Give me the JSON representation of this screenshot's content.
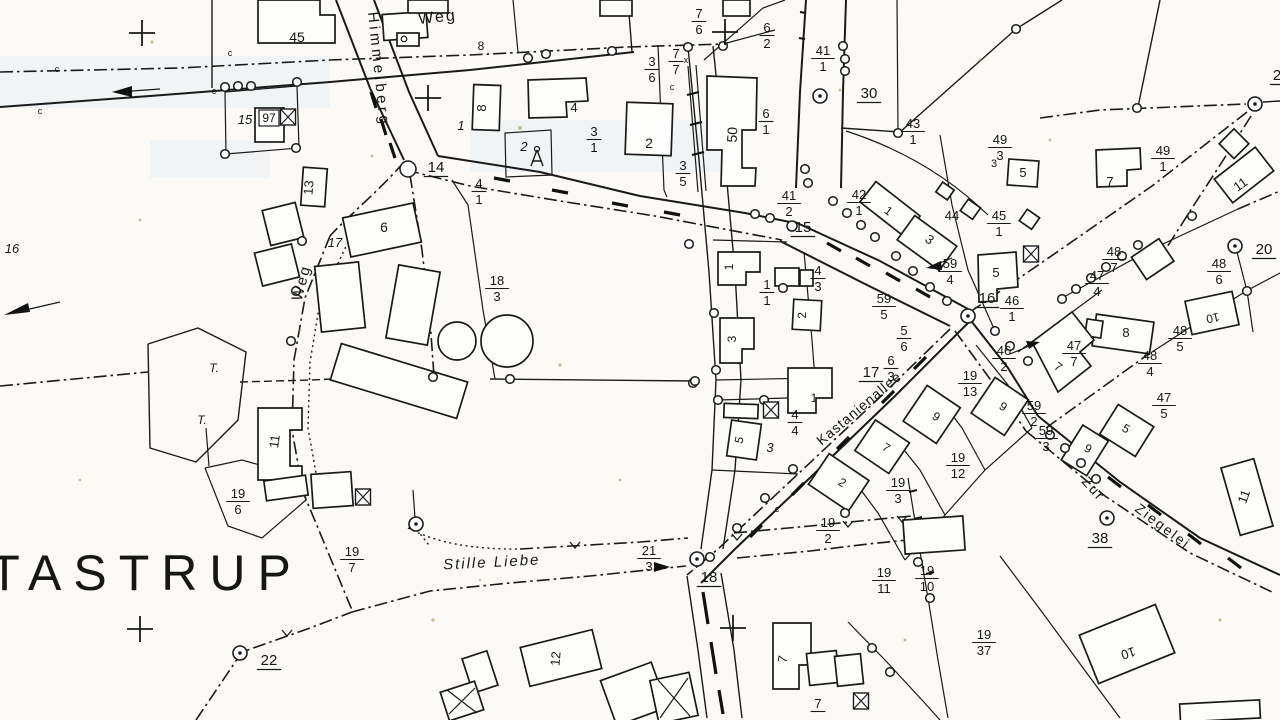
{
  "scan": {
    "background": "#fbfaf7",
    "ink": "#1a1a1a",
    "tint": "#d9e6ec",
    "speck": "#a8885a"
  },
  "map": {
    "place": "TASTRUP",
    "streets": [
      "Himmelberg",
      "Weg",
      "Weg",
      "Stille Liebe",
      "Kastanienallee",
      "Zur Ziegelei"
    ],
    "block_numbers": [
      "14",
      "15",
      "16",
      "17",
      "18",
      "20",
      "22",
      "30",
      "38",
      "2"
    ]
  },
  "labels": [
    {
      "type": "place",
      "text": "TASTRUP",
      "x": 146,
      "y": 590,
      "size": 50,
      "spacing": 12
    },
    {
      "type": "street",
      "text": "Weg",
      "x": 438,
      "y": 22,
      "rot": -6,
      "size": 16,
      "spacing": 2
    },
    {
      "type": "street",
      "text": "Himmelberg",
      "x": 374,
      "y": 70,
      "rot": 84,
      "size": 15,
      "spacing": 3.5
    },
    {
      "type": "street",
      "text": "Weg",
      "x": 306,
      "y": 284,
      "rot": -75,
      "size": 15,
      "spacing": 2
    },
    {
      "type": "street",
      "text": "Stille Liebe",
      "x": 492,
      "y": 567,
      "rot": -3,
      "size": 15,
      "spacing": 2,
      "style": "italic"
    },
    {
      "type": "street",
      "text": "Kastanienallee",
      "x": 862,
      "y": 412,
      "rot": -40,
      "size": 14,
      "spacing": 1
    },
    {
      "type": "street",
      "text": "Zur",
      "x": 1090,
      "y": 492,
      "rot": 48,
      "size": 14,
      "spacing": 2
    },
    {
      "type": "street",
      "text": "Ziegelei",
      "x": 1160,
      "y": 530,
      "rot": 37,
      "size": 14,
      "spacing": 2
    },
    {
      "type": "block",
      "text": "14",
      "x": 436,
      "y": 172
    },
    {
      "type": "block",
      "text": "15",
      "x": 803,
      "y": 232
    },
    {
      "type": "block",
      "text": "16",
      "x": 987,
      "y": 303
    },
    {
      "type": "block",
      "text": "17",
      "x": 871,
      "y": 377
    },
    {
      "type": "block",
      "text": "18",
      "x": 709,
      "y": 582
    },
    {
      "type": "block",
      "text": "20",
      "x": 1264,
      "y": 254
    },
    {
      "type": "block",
      "text": "22",
      "x": 269,
      "y": 665
    },
    {
      "type": "block",
      "text": "30",
      "x": 869,
      "y": 98
    },
    {
      "type": "block",
      "text": "38",
      "x": 1100,
      "y": 543
    },
    {
      "type": "block",
      "text": "2",
      "x": 1277,
      "y": 80
    },
    {
      "type": "parcel",
      "num": "7",
      "den": "6",
      "x": 699,
      "y": 20
    },
    {
      "type": "parcel",
      "num": "6",
      "den": "2",
      "x": 767,
      "y": 34
    },
    {
      "type": "parcel",
      "num": "3",
      "den": "6",
      "x": 652,
      "y": 68
    },
    {
      "type": "parcel",
      "num": "7",
      "den": "7",
      "x": 676,
      "y": 60
    },
    {
      "type": "parcel",
      "num": "41",
      "den": "1",
      "x": 823,
      "y": 57
    },
    {
      "type": "parcel",
      "num": "43",
      "den": "1",
      "x": 913,
      "y": 130
    },
    {
      "type": "parcel",
      "num": "49",
      "den": "3",
      "x": 1000,
      "y": 146
    },
    {
      "type": "parcel",
      "num": "49",
      "den": "1",
      "x": 1163,
      "y": 157
    },
    {
      "type": "parcel",
      "num": "6",
      "den": "1",
      "x": 766,
      "y": 120
    },
    {
      "type": "parcel",
      "num": "3",
      "den": "1",
      "x": 594,
      "y": 138
    },
    {
      "type": "parcel",
      "num": "3",
      "den": "5",
      "x": 683,
      "y": 172
    },
    {
      "type": "parcel",
      "num": "4",
      "den": "1",
      "x": 479,
      "y": 190
    },
    {
      "type": "parcel",
      "num": "42",
      "den": "1",
      "x": 859,
      "y": 201
    },
    {
      "type": "parcel",
      "num": "41",
      "den": "2",
      "x": 789,
      "y": 202
    },
    {
      "type": "parcel",
      "num": "45",
      "den": "1",
      "x": 999,
      "y": 222
    },
    {
      "type": "parcel",
      "num": "59",
      "den": "4",
      "x": 950,
      "y": 270
    },
    {
      "type": "parcel",
      "num": "4",
      "den": "3",
      "x": 818,
      "y": 277
    },
    {
      "type": "parcel",
      "num": "1",
      "den": "1",
      "x": 767,
      "y": 291
    },
    {
      "type": "parcel",
      "num": "5",
      "den": "6",
      "x": 904,
      "y": 337
    },
    {
      "type": "parcel",
      "num": "59",
      "den": "5",
      "x": 884,
      "y": 305
    },
    {
      "type": "parcel",
      "num": "46",
      "den": "1",
      "x": 1012,
      "y": 307
    },
    {
      "type": "parcel",
      "num": "48",
      "den": "7",
      "x": 1114,
      "y": 258
    },
    {
      "type": "parcel",
      "num": "47",
      "den": "4",
      "x": 1097,
      "y": 282
    },
    {
      "type": "parcel",
      "num": "48",
      "den": "6",
      "x": 1219,
      "y": 270
    },
    {
      "type": "parcel",
      "num": "46",
      "den": "2",
      "x": 1004,
      "y": 357
    },
    {
      "type": "parcel",
      "num": "19",
      "den": "13",
      "x": 970,
      "y": 382
    },
    {
      "type": "parcel",
      "num": "6",
      "den": "3",
      "x": 891,
      "y": 367
    },
    {
      "type": "parcel",
      "num": "48",
      "den": "5",
      "x": 1180,
      "y": 337
    },
    {
      "type": "parcel",
      "num": "48",
      "den": "4",
      "x": 1150,
      "y": 362
    },
    {
      "type": "parcel",
      "num": "47",
      "den": "7",
      "x": 1074,
      "y": 352
    },
    {
      "type": "parcel",
      "num": "47",
      "den": "5",
      "x": 1164,
      "y": 404
    },
    {
      "type": "parcel",
      "num": "59",
      "den": "2",
      "x": 1034,
      "y": 412
    },
    {
      "type": "parcel",
      "num": "59",
      "den": "3",
      "x": 1046,
      "y": 437
    },
    {
      "type": "parcel",
      "num": "4",
      "den": "4",
      "x": 795,
      "y": 421
    },
    {
      "type": "parcel",
      "num": "19",
      "den": "3",
      "x": 898,
      "y": 489
    },
    {
      "type": "parcel",
      "num": "19",
      "den": "12",
      "x": 958,
      "y": 464
    },
    {
      "type": "parcel",
      "num": "19",
      "den": "2",
      "x": 828,
      "y": 529
    },
    {
      "type": "parcel",
      "num": "19",
      "den": "11",
      "x": 884,
      "y": 579
    },
    {
      "type": "parcel",
      "num": "19",
      "den": "10",
      "x": 927,
      "y": 577
    },
    {
      "type": "parcel",
      "num": "21",
      "den": "3",
      "x": 649,
      "y": 557
    },
    {
      "type": "parcel",
      "num": "19",
      "den": "6",
      "x": 238,
      "y": 500
    },
    {
      "type": "parcel",
      "num": "19",
      "den": "7",
      "x": 352,
      "y": 558
    },
    {
      "type": "parcel",
      "num": "19",
      "den": "37",
      "x": 984,
      "y": 641
    },
    {
      "type": "parcel",
      "num": "18",
      "den": "3",
      "x": 497,
      "y": 287
    },
    {
      "type": "parcel",
      "num": "7",
      "den": "",
      "x": 818,
      "y": 710
    },
    {
      "type": "house",
      "text": "45",
      "x": 297,
      "y": 42,
      "size": 14
    },
    {
      "type": "house",
      "text": "8",
      "x": 481,
      "y": 50,
      "size": 12
    },
    {
      "type": "house",
      "text": "8",
      "x": 486,
      "y": 108,
      "rot": -90,
      "size": 13
    },
    {
      "type": "house",
      "text": "1",
      "x": 461,
      "y": 130,
      "style": "italic"
    },
    {
      "type": "house",
      "text": "4",
      "x": 574,
      "y": 112,
      "size": 13
    },
    {
      "type": "house",
      "text": "2",
      "x": 524,
      "y": 151,
      "style": "italic"
    },
    {
      "type": "house",
      "text": "2",
      "x": 649,
      "y": 148,
      "size": 14
    },
    {
      "type": "house",
      "text": "50",
      "x": 737,
      "y": 135,
      "rot": -87,
      "size": 14
    },
    {
      "type": "house",
      "text": "13",
      "x": 313,
      "y": 188,
      "rot": -85,
      "size": 13
    },
    {
      "type": "house",
      "text": "6",
      "x": 384,
      "y": 232,
      "size": 14
    },
    {
      "type": "house",
      "text": "17",
      "x": 335,
      "y": 247,
      "style": "italic"
    },
    {
      "type": "house",
      "text": "16",
      "x": 12,
      "y": 253,
      "style": "italic"
    },
    {
      "type": "house",
      "text": "15",
      "x": 245,
      "y": 124,
      "style": "italic"
    },
    {
      "type": "plate",
      "text": "97",
      "x": 269,
      "y": 122,
      "size": 12
    },
    {
      "type": "house",
      "text": "11",
      "x": 279,
      "y": 442,
      "rot": -82,
      "size": 13
    },
    {
      "type": "house",
      "text": "12",
      "x": 560,
      "y": 659,
      "rot": -85,
      "size": 13
    },
    {
      "type": "house",
      "text": "7",
      "x": 787,
      "y": 660,
      "rot": -80,
      "size": 13
    },
    {
      "type": "house",
      "text": "10",
      "x": 1127,
      "y": 649,
      "rot": 163,
      "size": 13
    },
    {
      "type": "house",
      "text": "11",
      "x": 1248,
      "y": 498,
      "rot": -70,
      "size": 13
    },
    {
      "type": "house",
      "text": "5",
      "x": 743,
      "y": 441,
      "rot": -75,
      "size": 12
    },
    {
      "type": "house",
      "text": "3",
      "x": 770,
      "y": 452,
      "style": "italic"
    },
    {
      "type": "house",
      "text": "1",
      "x": 814,
      "y": 402,
      "size": 12
    },
    {
      "type": "house",
      "text": "2",
      "x": 840,
      "y": 486,
      "rot": 33,
      "size": 12
    },
    {
      "type": "house",
      "text": "7",
      "x": 884,
      "y": 451,
      "rot": 33,
      "size": 12
    },
    {
      "type": "house",
      "text": "9",
      "x": 934,
      "y": 420,
      "rot": 33,
      "size": 12
    },
    {
      "type": "house",
      "text": "9",
      "x": 1001,
      "y": 410,
      "rot": 33,
      "size": 12
    },
    {
      "type": "house",
      "text": "9",
      "x": 1086,
      "y": 452,
      "rot": 30,
      "size": 12
    },
    {
      "type": "house",
      "text": "5",
      "x": 1124,
      "y": 432,
      "rot": 30,
      "size": 12
    },
    {
      "type": "house",
      "text": "7",
      "x": 1056,
      "y": 370,
      "rot": 35,
      "size": 12
    },
    {
      "type": "house",
      "text": "8",
      "x": 1126,
      "y": 337,
      "size": 13
    },
    {
      "type": "house",
      "text": "10",
      "x": 1212,
      "y": 314,
      "rot": 168,
      "size": 12
    },
    {
      "type": "house",
      "text": "1",
      "x": 733,
      "y": 267,
      "rot": -90,
      "size": 12
    },
    {
      "type": "house",
      "text": "3",
      "x": 736,
      "y": 339,
      "rot": -90,
      "size": 12
    },
    {
      "type": "house",
      "text": "2",
      "x": 806,
      "y": 315,
      "rot": -93,
      "size": 12
    },
    {
      "type": "house",
      "text": "1",
      "x": 886,
      "y": 214,
      "rot": 38,
      "size": 12
    },
    {
      "type": "house",
      "text": "3",
      "x": 927,
      "y": 243,
      "rot": 36,
      "size": 13
    },
    {
      "type": "house",
      "text": "5",
      "x": 996,
      "y": 277,
      "size": 13
    },
    {
      "type": "house",
      "text": "44",
      "x": 952,
      "y": 220,
      "size": 13
    },
    {
      "type": "house",
      "text": "3",
      "x": 994,
      "y": 167,
      "size": 11
    },
    {
      "type": "house",
      "text": "5",
      "x": 1023,
      "y": 177,
      "size": 13
    },
    {
      "type": "house",
      "text": "7",
      "x": 1110,
      "y": 186,
      "size": 13
    },
    {
      "type": "house",
      "text": "11",
      "x": 1243,
      "y": 188,
      "rot": -36,
      "size": 13
    },
    {
      "type": "note",
      "text": "T.",
      "x": 214,
      "y": 372,
      "size": 12,
      "style": "italic"
    },
    {
      "type": "note",
      "text": "T.",
      "x": 202,
      "y": 424,
      "size": 12,
      "style": "italic"
    },
    {
      "type": "note",
      "text": "c",
      "x": 57,
      "y": 72,
      "size": 9
    },
    {
      "type": "note",
      "text": "c",
      "x": 40,
      "y": 114,
      "size": 9
    },
    {
      "type": "note",
      "text": "c",
      "x": 230,
      "y": 56,
      "size": 9
    },
    {
      "type": "note",
      "text": "c",
      "x": 214,
      "y": 94,
      "size": 9
    },
    {
      "type": "note",
      "text": "c",
      "x": 672,
      "y": 90,
      "size": 9
    },
    {
      "type": "note",
      "text": "c",
      "x": 777,
      "y": 512,
      "size": 9
    },
    {
      "type": "note",
      "text": "x",
      "x": 686,
      "y": 63,
      "size": 9
    }
  ],
  "markers": {
    "survey_points": [
      [
        820,
        96
      ],
      [
        1255,
        104
      ],
      [
        968,
        316
      ],
      [
        1107,
        518
      ],
      [
        697,
        559
      ],
      [
        240,
        653
      ],
      [
        416,
        524
      ],
      [
        1235,
        246
      ]
    ],
    "grid_crosses": [
      [
        142,
        33
      ],
      [
        428,
        98
      ],
      [
        140,
        629
      ],
      [
        733,
        628
      ],
      [
        725,
        32
      ]
    ],
    "crossed_squares": [
      [
        288,
        117
      ],
      [
        771,
        410
      ],
      [
        861,
        701
      ],
      [
        363,
        497
      ],
      [
        1031,
        254
      ]
    ],
    "tower_symbols": [
      [
        537,
        158
      ]
    ],
    "boundary_points": [
      [
        225,
        87
      ],
      [
        238,
        86
      ],
      [
        251,
        86
      ],
      [
        297,
        82
      ],
      [
        225,
        154
      ],
      [
        296,
        148
      ],
      [
        612,
        51
      ],
      [
        528,
        58
      ],
      [
        546,
        54
      ],
      [
        688,
        47
      ],
      [
        723,
        46
      ],
      [
        843,
        46
      ],
      [
        845,
        59
      ],
      [
        845,
        71
      ],
      [
        805,
        169
      ],
      [
        808,
        183
      ],
      [
        898,
        133
      ],
      [
        1016,
        29
      ],
      [
        1137,
        108
      ],
      [
        408,
        169,
        8
      ],
      [
        689,
        244
      ],
      [
        714,
        313
      ],
      [
        693,
        383
      ],
      [
        716,
        370
      ],
      [
        718,
        400
      ],
      [
        764,
        400
      ],
      [
        783,
        288
      ],
      [
        792,
        226,
        5
      ],
      [
        833,
        201
      ],
      [
        847,
        213
      ],
      [
        861,
        225
      ],
      [
        875,
        237
      ],
      [
        896,
        256
      ],
      [
        913,
        271
      ],
      [
        930,
        287
      ],
      [
        947,
        301
      ],
      [
        1010,
        346
      ],
      [
        1028,
        361
      ],
      [
        995,
        331
      ],
      [
        302,
        241
      ],
      [
        296,
        291
      ],
      [
        291,
        341
      ],
      [
        793,
        469
      ],
      [
        765,
        498
      ],
      [
        737,
        528
      ],
      [
        710,
        557
      ],
      [
        1050,
        435
      ],
      [
        1065,
        448
      ],
      [
        1081,
        463
      ],
      [
        1096,
        479
      ],
      [
        1062,
        299
      ],
      [
        1076,
        289
      ],
      [
        1091,
        278
      ],
      [
        1106,
        267
      ],
      [
        1122,
        256
      ],
      [
        1138,
        245
      ],
      [
        1247,
        291
      ],
      [
        1192,
        216
      ],
      [
        510,
        379
      ],
      [
        695,
        381
      ],
      [
        433,
        377
      ],
      [
        845,
        513
      ],
      [
        872,
        648
      ],
      [
        890,
        672
      ],
      [
        918,
        562
      ],
      [
        930,
        598
      ],
      [
        755,
        214
      ],
      [
        770,
        218
      ]
    ]
  }
}
